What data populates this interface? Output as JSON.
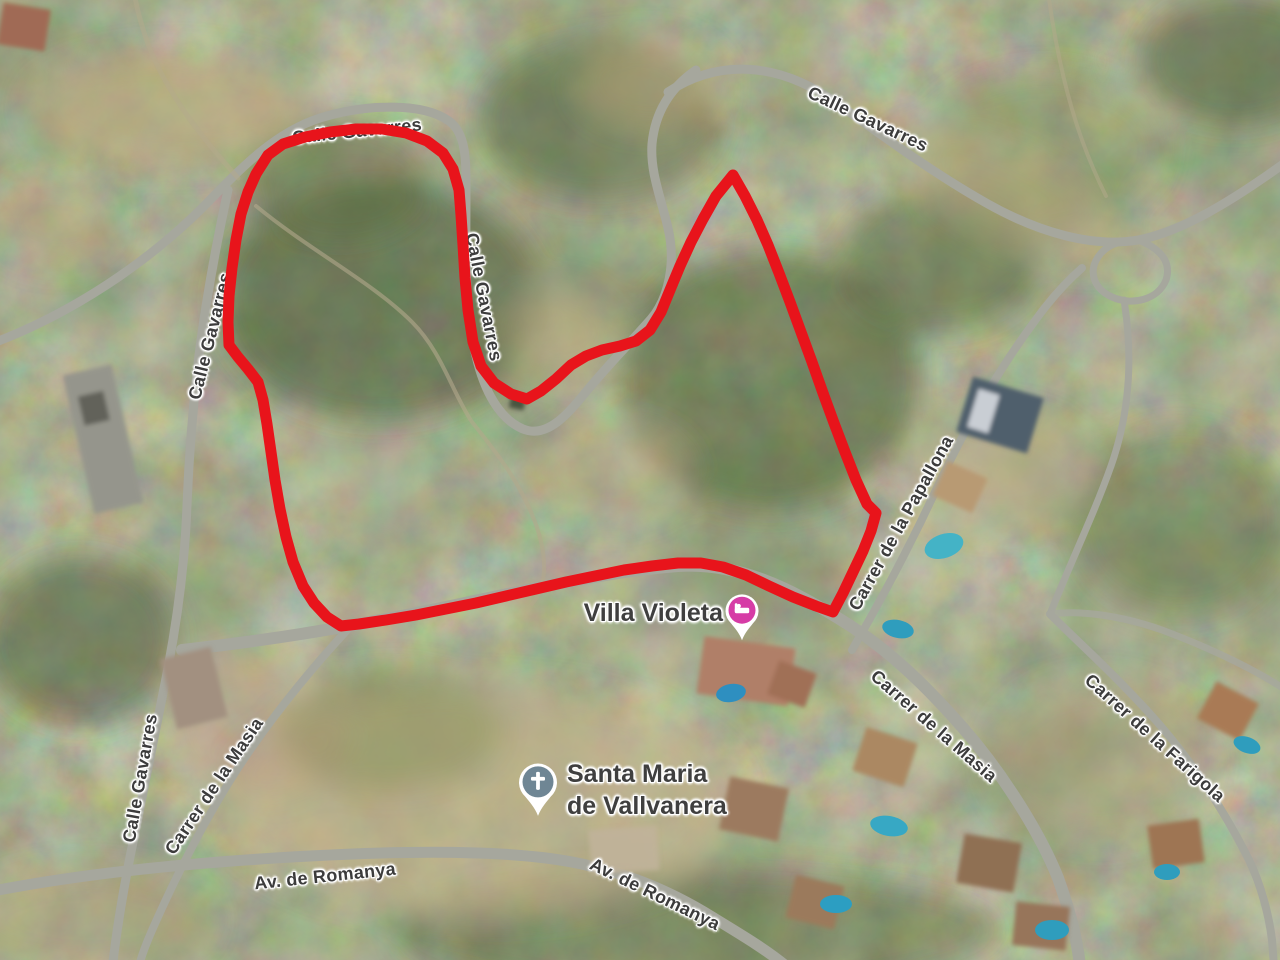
{
  "map": {
    "view": "satellite",
    "road_labels": [
      {
        "text": "Calle Gavarres"
      },
      {
        "text": "Calle Gavarres"
      },
      {
        "text": "Calle Gavarres"
      },
      {
        "text": "Calle Gavarres"
      },
      {
        "text": "Carrer de la Papallona"
      },
      {
        "text": "Carrer de la Masia"
      },
      {
        "text": "Carrer de la Farigola"
      },
      {
        "text": "Calle Gavarres"
      },
      {
        "text": "Carrer de la Masia"
      },
      {
        "text": "Av. de Romanya"
      },
      {
        "text": "Av. de Romanya"
      }
    ],
    "places": [
      {
        "name": "Villa Violeta",
        "icon": "lodging-pin",
        "pin_color": "#d63ca6"
      },
      {
        "name_line1": "Santa Maria",
        "name_line2": "de Vallvanera",
        "icon": "church-pin",
        "pin_color": "#6f8694"
      }
    ],
    "boundary": {
      "color": "#e8141b"
    }
  }
}
